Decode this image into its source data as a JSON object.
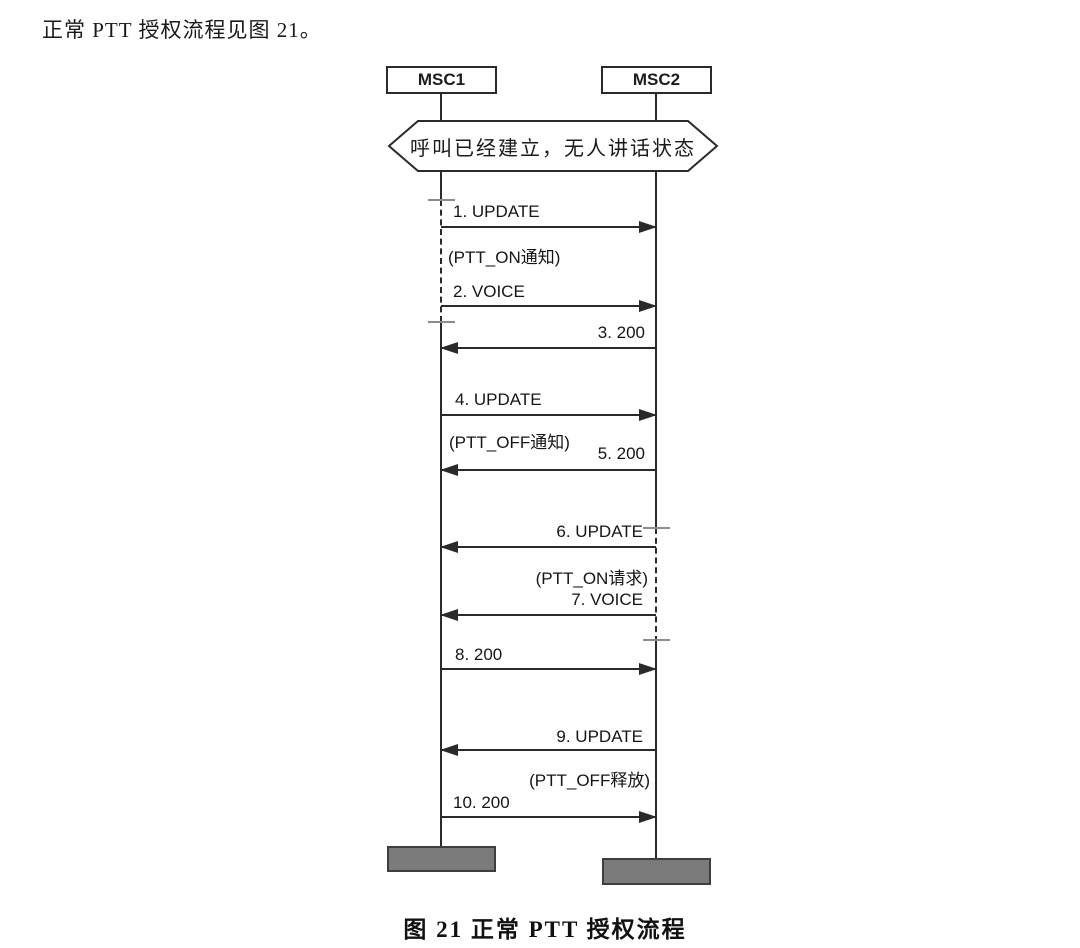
{
  "intro_text": "正常 PTT 授权流程见图 21。",
  "actors": {
    "left": "MSC1",
    "right": "MSC2"
  },
  "state_note": "呼叫已经建立，无人讲话状态",
  "messages": [
    {
      "label": "1. UPDATE",
      "note": "(PTT_ON通知)",
      "direction": "right",
      "from": "MSC1",
      "to": "MSC2"
    },
    {
      "label": "2. VOICE",
      "note": "",
      "direction": "right",
      "from": "MSC1",
      "to": "MSC2"
    },
    {
      "label": "3. 200",
      "note": "",
      "direction": "left",
      "from": "MSC2",
      "to": "MSC1"
    },
    {
      "label": "4. UPDATE",
      "note": "(PTT_OFF通知)",
      "direction": "right",
      "from": "MSC1",
      "to": "MSC2"
    },
    {
      "label": "5. 200",
      "note": "",
      "direction": "left",
      "from": "MSC2",
      "to": "MSC1"
    },
    {
      "label": "6. UPDATE",
      "note": "(PTT_ON请求)",
      "direction": "left",
      "from": "MSC2",
      "to": "MSC1"
    },
    {
      "label": "7. VOICE",
      "note": "",
      "direction": "left",
      "from": "MSC2",
      "to": "MSC1"
    },
    {
      "label": "8. 200",
      "note": "",
      "direction": "right",
      "from": "MSC1",
      "to": "MSC2"
    },
    {
      "label": "9. UPDATE",
      "note": "(PTT_OFF释放)",
      "direction": "left",
      "from": "MSC2",
      "to": "MSC1"
    },
    {
      "label": "10. 200",
      "note": "",
      "direction": "right",
      "from": "MSC1",
      "to": "MSC2"
    }
  ],
  "caption": "图 21  正常 PTT 授权流程",
  "colors": {
    "line": "#2a2a2a",
    "tick": "#8c8c8c",
    "bar_fill": "#7b7b7b",
    "bar_border": "#3e3e3e"
  }
}
